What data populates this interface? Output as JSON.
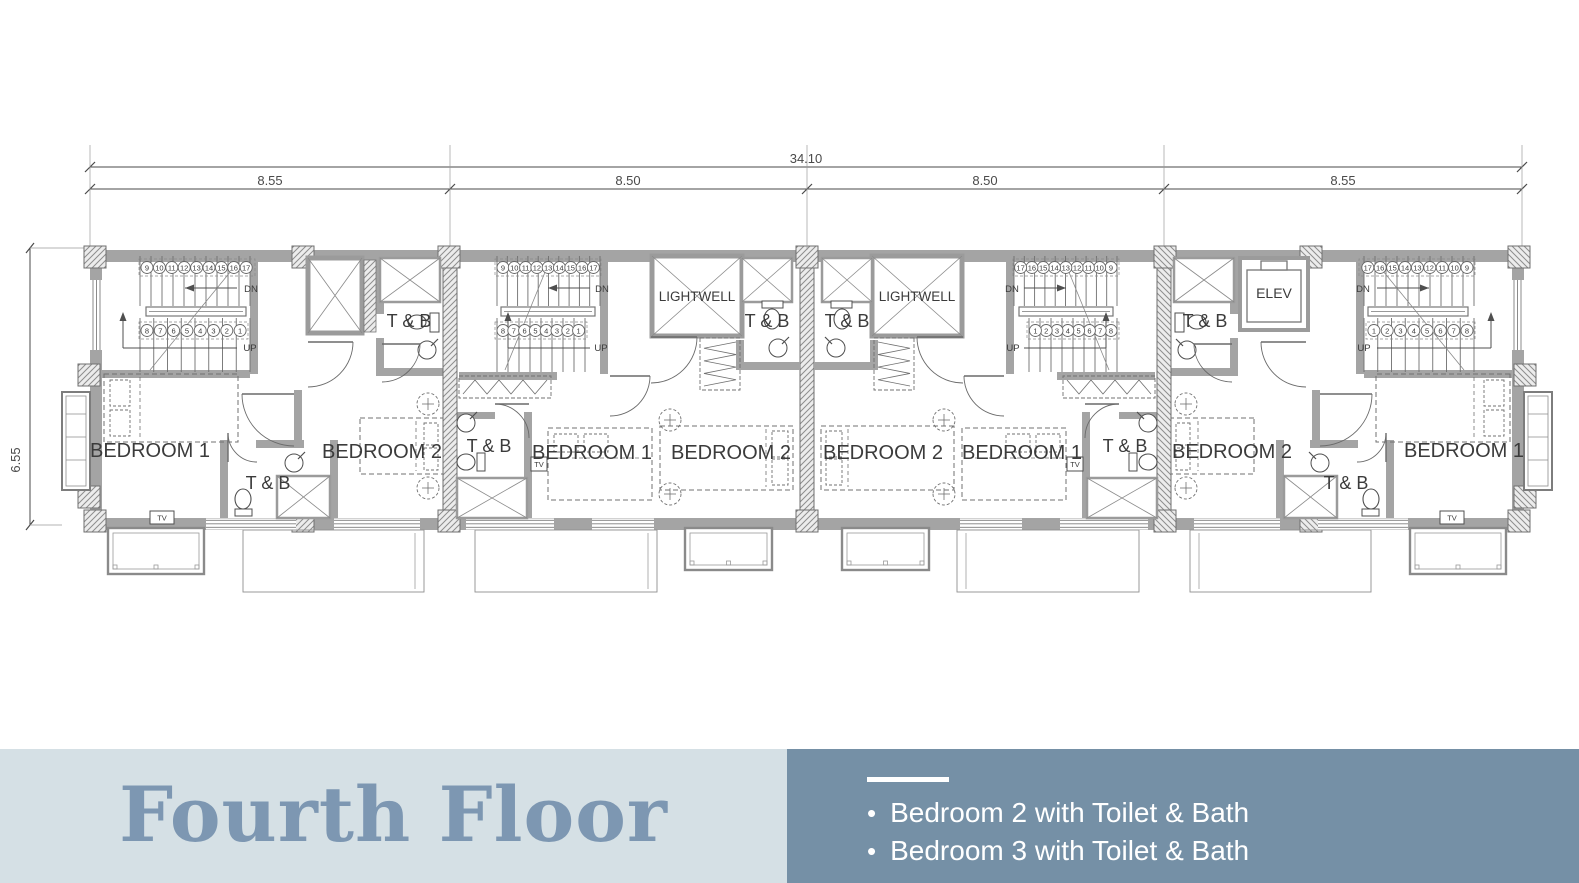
{
  "plan": {
    "dim_total": "34.10",
    "dim_segments": [
      "8.55",
      "8.50",
      "8.50",
      "8.55"
    ],
    "dim_height": "6.55",
    "labels": {
      "bedroom1": "BEDROOM 1",
      "bedroom2": "BEDROOM 2",
      "toilet_bath": "T & B",
      "lightwell": "LIGHTWELL",
      "elevator": "ELEV",
      "down": "DN",
      "up": "UP",
      "tv": "TV"
    },
    "stairs": {
      "upper_numbers": [
        "9",
        "10",
        "11",
        "12",
        "13",
        "14",
        "15",
        "16",
        "17"
      ],
      "lower_numbers": [
        "8",
        "7",
        "6",
        "5",
        "4",
        "3",
        "2",
        "1"
      ]
    },
    "colors": {
      "wall": "#a4a4a4",
      "line": "#4f4f4f",
      "text": "#3b3b3b"
    }
  },
  "footer": {
    "title": "Fourth Floor",
    "bullet": "•",
    "items": [
      "Bedroom 2 with Toilet & Bath",
      "Bedroom 3 with Toilet & Bath"
    ],
    "colors": {
      "left_bg": "#d5e0e5",
      "right_bg": "#7590a6",
      "title": "#7d97b2",
      "list_text": "#ffffff"
    }
  }
}
